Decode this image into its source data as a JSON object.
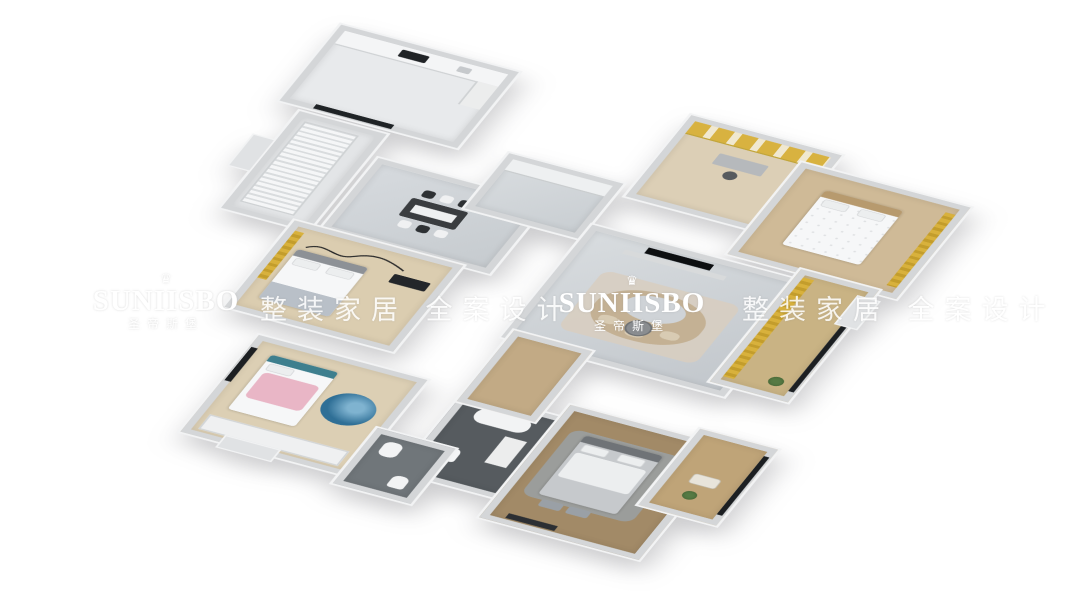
{
  "image": {
    "type": "3d-isometric-floorplan-render",
    "background": "#ffffff"
  },
  "watermark": {
    "brand": "SUNIISBO",
    "brand_zh": "圣帝斯堡",
    "slogan_zh": "整装家居 全案设计",
    "crown_icon": "♛",
    "color": "#ffffff"
  },
  "palette": {
    "wall": "#d4d6d8",
    "wall_top": "#f2f3f4",
    "marble_floor": "#ced2d6",
    "light_wood_floor": "#dccfb4",
    "dark_wood_floor": "#a28a67",
    "accent_yellow": "#d8b13c",
    "accent_pink": "#e9b6c6",
    "accent_teal": "#3e7f8e",
    "bath_dark": "#565b5f",
    "sofa_beige": "#c4b194",
    "tv_black": "#0d0f11"
  }
}
